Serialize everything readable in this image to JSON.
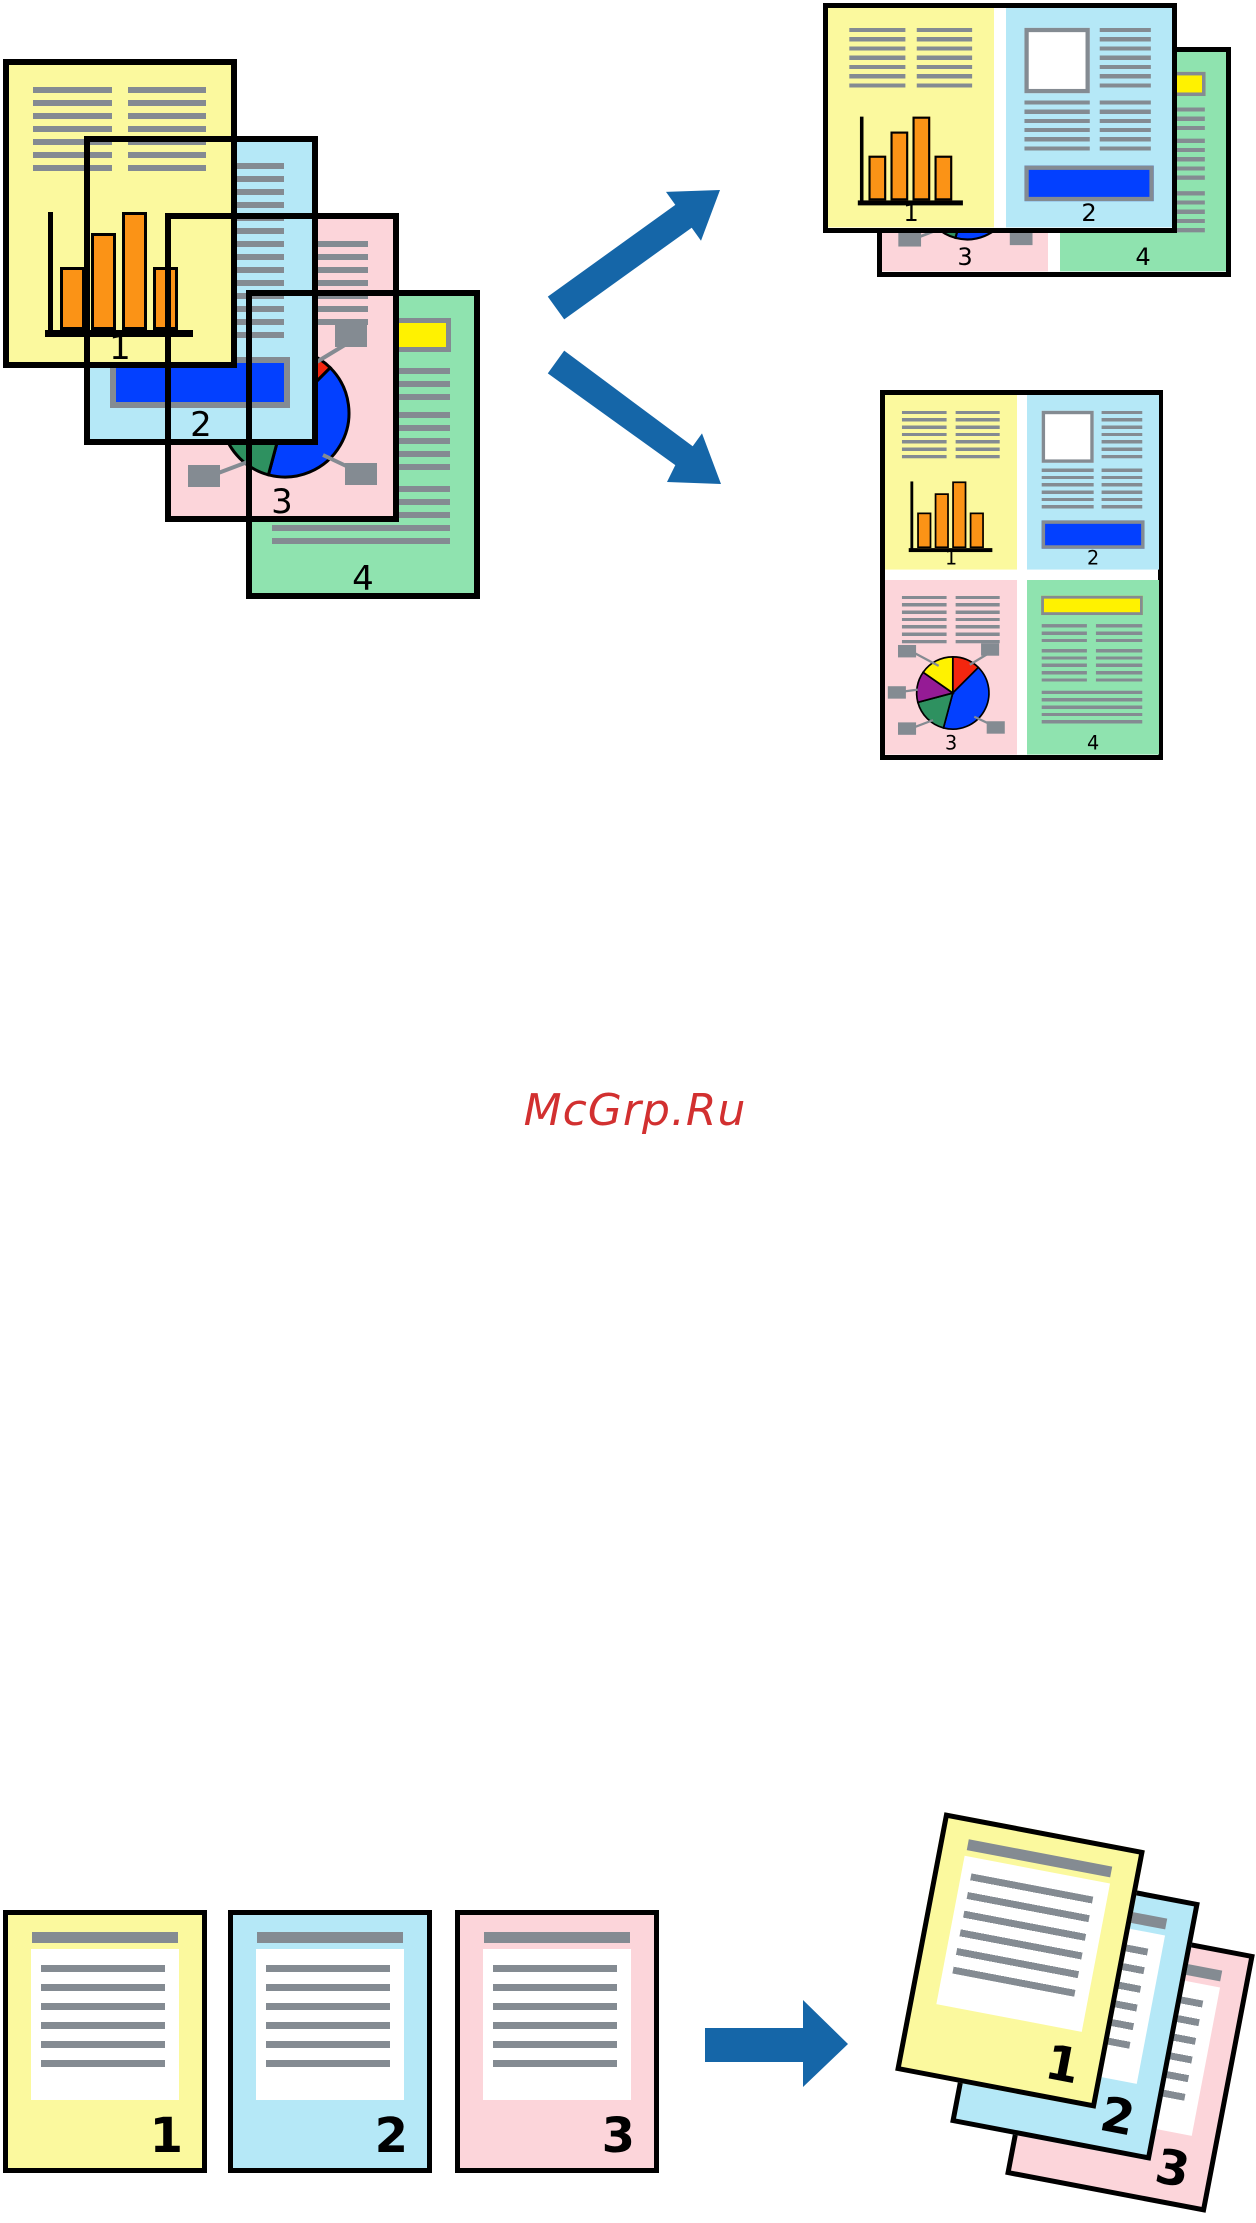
{
  "watermark": {
    "text": "McGrp.Ru"
  },
  "palette": {
    "page_yellow": "#FBF99E",
    "page_blue": "#B5E8F7",
    "page_pink": "#FCD5DA",
    "page_green": "#8FE3AF",
    "line_gray": "#848B92",
    "bar_orange": "#FB9316",
    "accent_blue": "#0340FF",
    "pie_red": "#F3260F",
    "pie_green": "#2E9160",
    "pie_purple": "#951B95",
    "pie_yellow": "#FFF200",
    "highlight_yellow": "#FFF200",
    "arrow_blue": "#1566A8",
    "watermark_red": "#D23030"
  },
  "source_stack": {
    "pages": [
      {
        "number": "1"
      },
      {
        "number": "2"
      },
      {
        "number": "3"
      },
      {
        "number": "4"
      }
    ]
  },
  "two_up_output": {
    "front_sheet": {
      "left_number": "1",
      "right_number": "2"
    },
    "back_sheet": {
      "left_number": "3",
      "right_number": "4"
    }
  },
  "four_up_output": {
    "numbers": [
      "1",
      "2",
      "3",
      "4"
    ]
  },
  "collate_input": {
    "pages": [
      {
        "number": "1"
      },
      {
        "number": "2"
      },
      {
        "number": "3"
      }
    ]
  },
  "collate_output": {
    "pages": [
      {
        "number": "1"
      },
      {
        "number": "2"
      },
      {
        "number": "3"
      }
    ]
  }
}
